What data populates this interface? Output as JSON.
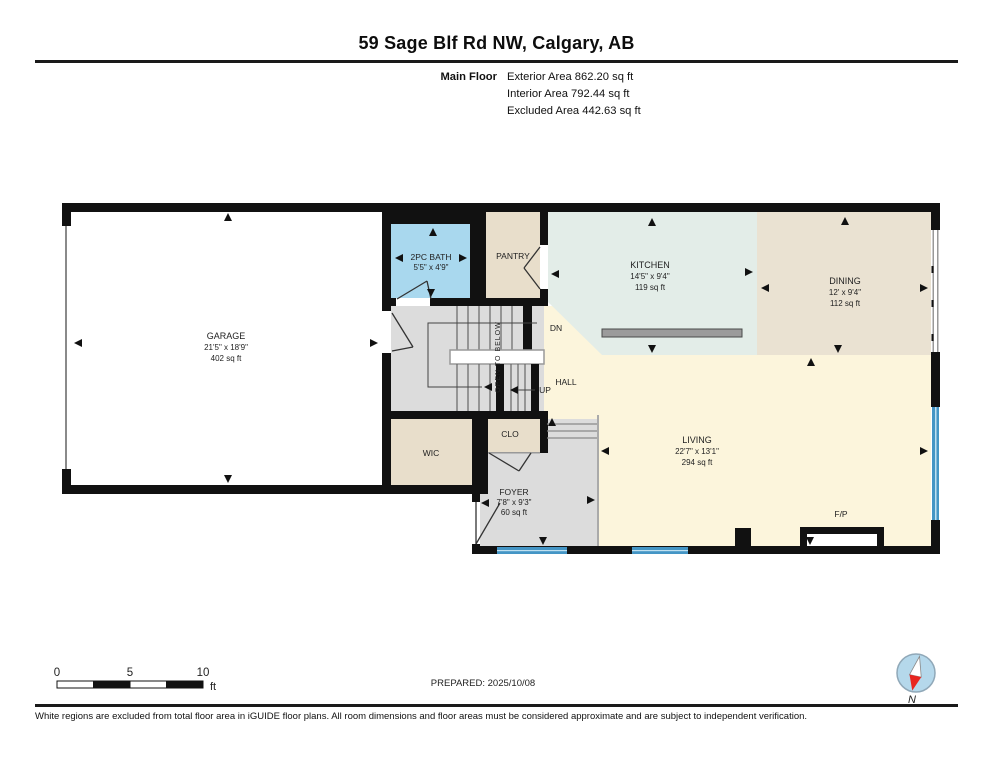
{
  "header": {
    "title": "59 Sage Blf Rd NW, Calgary, AB",
    "floor_label": "Main Floor",
    "area_lines": [
      "Exterior Area 862.20 sq ft",
      "Interior Area 792.44 sq ft",
      "Excluded Area 442.63 sq ft"
    ]
  },
  "plan": {
    "rooms": {
      "garage": {
        "name": "GARAGE",
        "dims": "21'5\" x 18'9\"",
        "area": "402 sq ft"
      },
      "bath": {
        "name": "2PC BATH",
        "dims": "5'5\" x 4'9\""
      },
      "pantry": {
        "name": "PANTRY"
      },
      "kitchen": {
        "name": "KITCHEN",
        "dims": "14'5\" x 9'4\"",
        "area": "119 sq ft"
      },
      "dining": {
        "name": "DINING",
        "dims": "12' x 9'4\"",
        "area": "112 sq ft"
      },
      "living": {
        "name": "LIVING",
        "dims": "22'7\" x 13'1\"",
        "area": "294 sq ft"
      },
      "hall": {
        "name": "HALL"
      },
      "wic": {
        "name": "WIC"
      },
      "clo": {
        "name": "CLO"
      },
      "foyer": {
        "name": "FOYER",
        "dims": "7'8\" x 9'3\"",
        "area": "60 sq ft"
      },
      "fireplace": {
        "name": "F/P"
      }
    },
    "stairs": {
      "dn": "DN",
      "up": "UP",
      "open_to_below": "OPEN TO BELOW"
    }
  },
  "scale_bar": {
    "tick0": "0",
    "tick5": "5",
    "tick10": "10",
    "unit": "ft"
  },
  "footer": {
    "prepared": "PREPARED: 2025/10/08",
    "compass_label": "N",
    "disclaimer": "White regions are excluded from total floor area in iGUIDE floor plans. All room dimensions and floor areas must be considered approximate and are subject to independent verification."
  },
  "colors": {
    "wall": "#111111",
    "garage_floor": "#ffffff",
    "bath_floor": "#a9d8ee",
    "tan_floor": "#e8decb",
    "kitchen_floor": "#e3ede8",
    "dining_floor": "#eae2d2",
    "living_floor": "#fcf5dc",
    "gray_floor": "#dcdcdc",
    "window_blue": "#4495c5",
    "compass_red": "#e8251f"
  }
}
